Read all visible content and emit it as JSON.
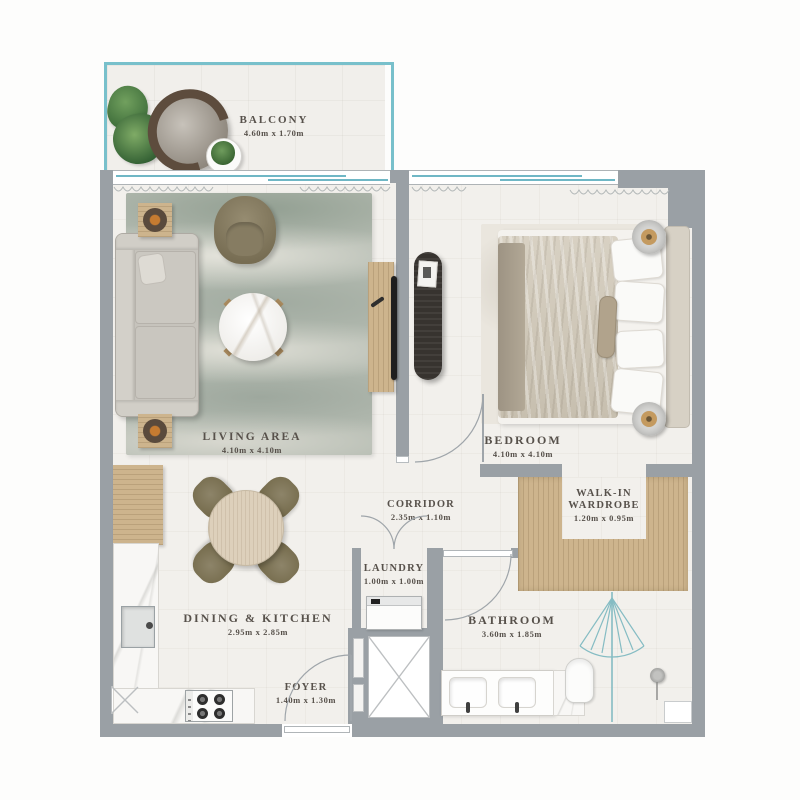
{
  "plan_title": "Apartment floor plan",
  "rooms": [
    {
      "name": "BALCONY",
      "dims": "4.60m x 1.70m"
    },
    {
      "name": "LIVING AREA",
      "dims": "4.10m x 4.10m"
    },
    {
      "name": "BEDROOM",
      "dims": "4.10m x 4.10m"
    },
    {
      "name": "CORRIDOR",
      "dims": "2.35m x 1.10m"
    },
    {
      "name": "WALK-IN WARDROBE",
      "dims": "1.20m x 0.95m"
    },
    {
      "name": "LAUNDRY",
      "dims": "1.00m x 1.00m"
    },
    {
      "name": "DINING & KITCHEN",
      "dims": "2.95m x 2.85m"
    },
    {
      "name": "BATHROOM",
      "dims": "3.60m x 1.85m"
    },
    {
      "name": "FOYER",
      "dims": "1.40m x 1.30m"
    }
  ],
  "colors": {
    "wall": "#9aa0a5",
    "window_accent": "#6fb7c5",
    "balcony_border": "#78c0cb",
    "wood": "#cdb48d",
    "floor": "#f2f0ec",
    "label_text": "#57514b",
    "furniture_olive": "#857b61",
    "rug_green_gray": "#b4bbb1"
  }
}
